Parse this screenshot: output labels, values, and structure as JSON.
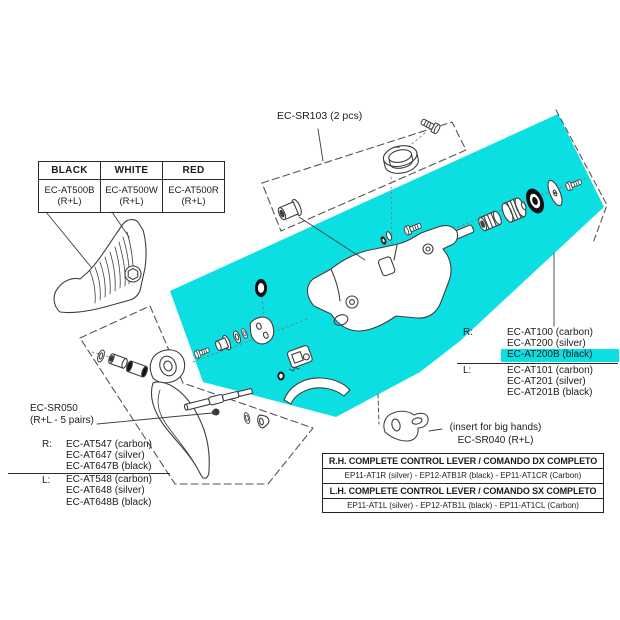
{
  "colors": {
    "highlight_cyan": "#0cdfe2",
    "line_art": "#3f3f3f",
    "text": "#1c1c1c"
  },
  "labels": {
    "sr103": "EC-SR103 (2 pcs)",
    "sr050_line1": "EC-SR050",
    "sr050_line2": "(R+L - 5 pairs)",
    "insert_line1": "(insert for big hands)",
    "insert_line2": "EC-SR040 (R+L)",
    "right_marker": "R:",
    "left_marker": "L:"
  },
  "color_table": {
    "headers": [
      "BLACK",
      "WHITE",
      "RED"
    ],
    "cells": [
      {
        "code": "EC-AT500B",
        "suffix": "(R+L)"
      },
      {
        "code": "EC-AT500W",
        "suffix": "(R+L)"
      },
      {
        "code": "EC-AT500R",
        "suffix": "(R+L)"
      }
    ]
  },
  "right_parts_list": {
    "r_items": [
      "EC-AT100 (carbon)",
      "EC-AT200 (silver)",
      "EC-AT200B (black)"
    ],
    "l_items": [
      "EC-AT101 (carbon)",
      "EC-AT201 (silver)",
      "EC-AT201B (black)"
    ],
    "highlighted_item": "EC-AT200B (black)"
  },
  "left_parts_list": {
    "r_items": [
      "EC-AT547 (carbon)",
      "EC-AT647 (silver)",
      "EC-AT647B (black)"
    ],
    "l_items": [
      "EC-AT548 (carbon)",
      "EC-AT648 (silver)",
      "EC-AT648B (black)"
    ]
  },
  "lever_table": {
    "rows": [
      {
        "text": "R.H. COMPLETE CONTROL LEVER / COMANDO DX COMPLETO"
      },
      {
        "text": "EP11-AT1R (silver) - EP12-ATB1R (black) -  EP11-AT1CR (Carbon)"
      },
      {
        "text": "L.H. COMPLETE CONTROL LEVER / COMANDO SX COMPLETO"
      },
      {
        "text": "EP11-AT1L (silver) - EP12-ATB1L (black) -  EP11-AT1CL (Carbon)"
      }
    ]
  }
}
